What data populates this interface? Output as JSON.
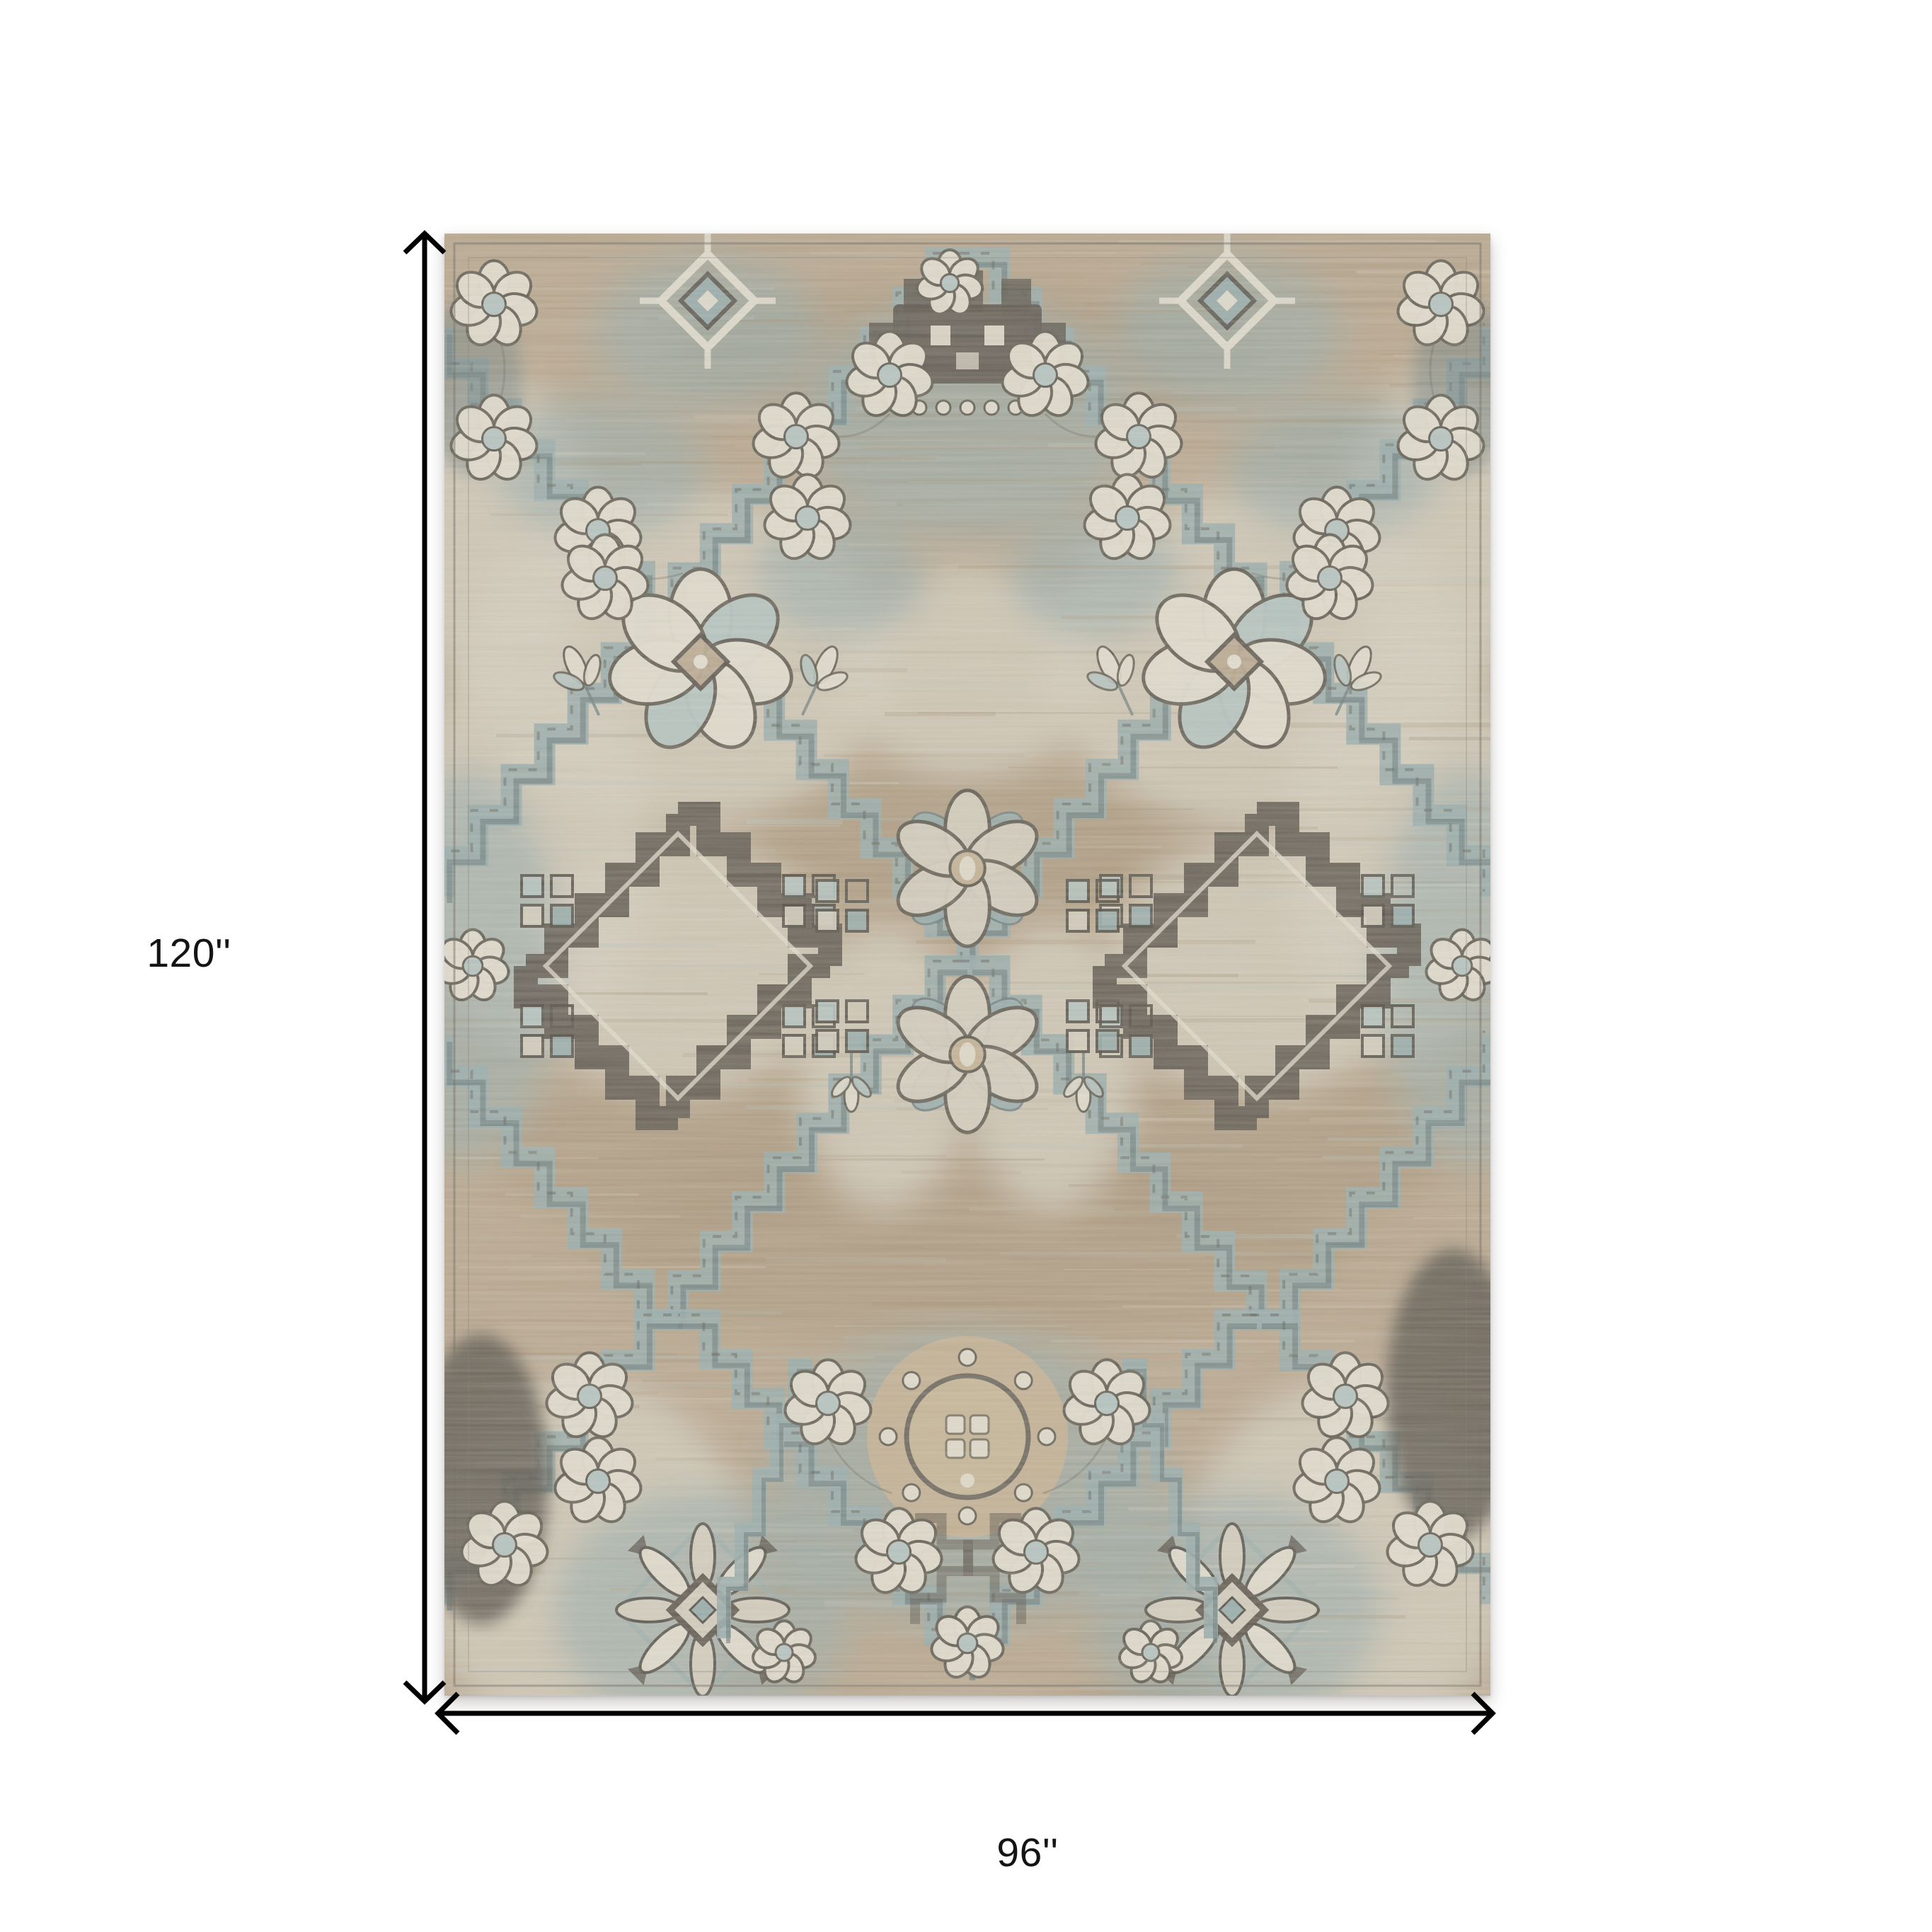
{
  "scene": {
    "background_color": "#ffffff",
    "description": "Product dimension diagram of an ornate beige and slate-blue Persian-style area rug with floral trellis pattern, annotated with height and width measurement arrows"
  },
  "dimension_annotations": {
    "height_label": "120''",
    "width_label": "96''",
    "arrow_color": "#000000",
    "label_color": "#141414"
  },
  "rug": {
    "palette": {
      "ground": "#b7a389",
      "ground_light": "#cfc0a4",
      "ground_dark": "#a18c6e",
      "tan": "#c4b08e",
      "cream": "#d9d3c3",
      "ivory": "#e9e4d6",
      "slate": "#8fa9ab",
      "slate_light": "#b3c6c5",
      "slate_dark": "#5f7578",
      "charcoal": "#4a443c",
      "outline": "#4f4b42"
    }
  }
}
